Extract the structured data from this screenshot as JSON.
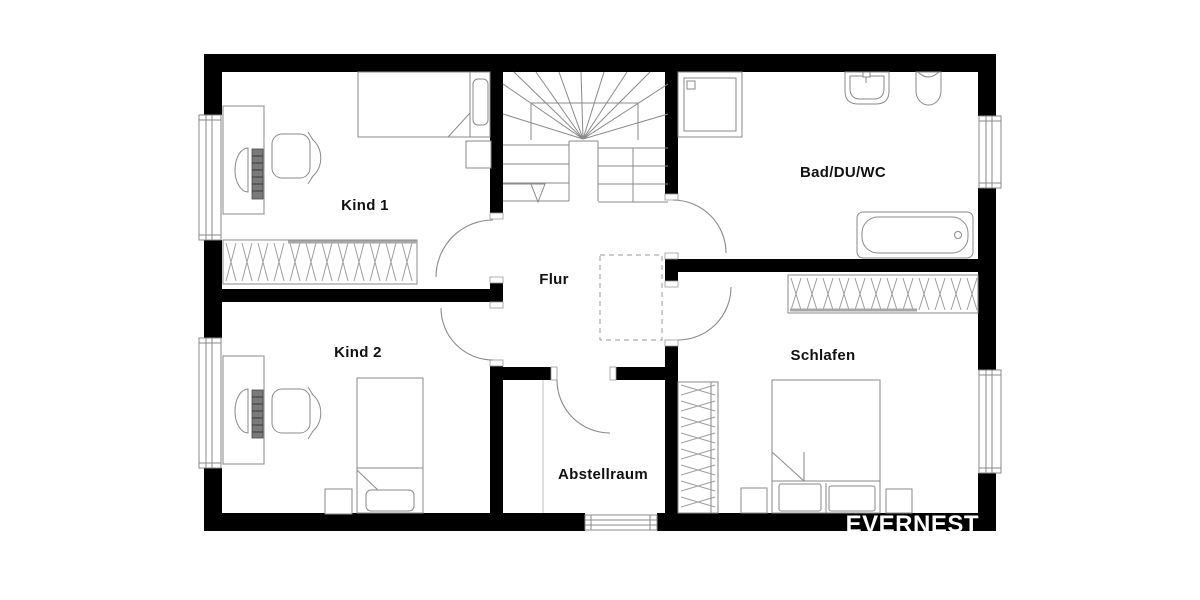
{
  "floorplan": {
    "watermark": "EVERNEST",
    "rooms": {
      "kind1": {
        "label": "Kind 1"
      },
      "kind2": {
        "label": "Kind 2"
      },
      "flur": {
        "label": "Flur"
      },
      "abstellraum": {
        "label": "Abstellraum"
      },
      "bad": {
        "label": "Bad/DU/WC"
      },
      "schlafen": {
        "label": "Schlafen"
      }
    },
    "furniture_icons": {
      "kind1": [
        "desk-icon",
        "office-chair-icon",
        "single-bed-icon",
        "nightstand-icon",
        "wardrobe-icon"
      ],
      "kind2": [
        "desk-icon",
        "office-chair-icon",
        "single-bed-icon",
        "nightstand-icon"
      ],
      "flur": [
        "staircase-icon"
      ],
      "abstellraum": [],
      "bad": [
        "shower-icon",
        "washbasin-icon",
        "toilet-icon",
        "bathtub-icon"
      ],
      "schlafen": [
        "double-bed-icon",
        "nightstand-icon",
        "wardrobe-icon",
        "wardrobe-icon"
      ]
    },
    "colors": {
      "background": "#ffffff",
      "wall": "#000000",
      "furniture_line": "#8a8a8a",
      "hatch_line": "#9e9e9e",
      "label_text": "#111111",
      "watermark_text": "#ffffff"
    }
  }
}
